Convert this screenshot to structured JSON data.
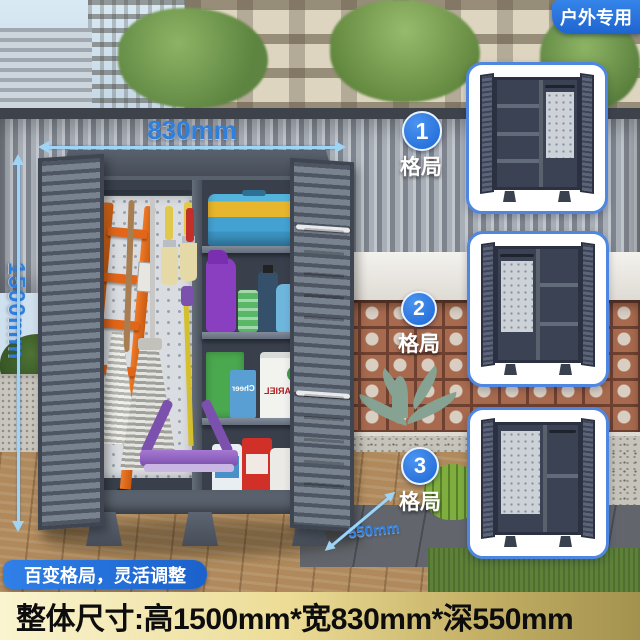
{
  "corner_badge": {
    "label": "户外专用"
  },
  "dimensions": {
    "width": "830mm",
    "height": "1500mm",
    "depth": "550mm"
  },
  "layout_options": {
    "items": [
      {
        "number": "1",
        "label": "格局"
      },
      {
        "number": "2",
        "label": "格局"
      },
      {
        "number": "3",
        "label": "格局"
      }
    ]
  },
  "banner": {
    "label": "百变格局，灵活调整"
  },
  "footer": {
    "size_text": "整体尺寸:高1500mm*宽830mm*深550mm"
  },
  "products": {
    "tub_brand": "ARIEL",
    "box_brand": "Cheer"
  },
  "colors": {
    "accent_blue": "#2277e8",
    "dimension_blue": "#2f7fdd",
    "cabinet_slate": "#49525f",
    "footer_bg_left": "#faf4d0",
    "footer_bg_right": "#a3924f"
  }
}
